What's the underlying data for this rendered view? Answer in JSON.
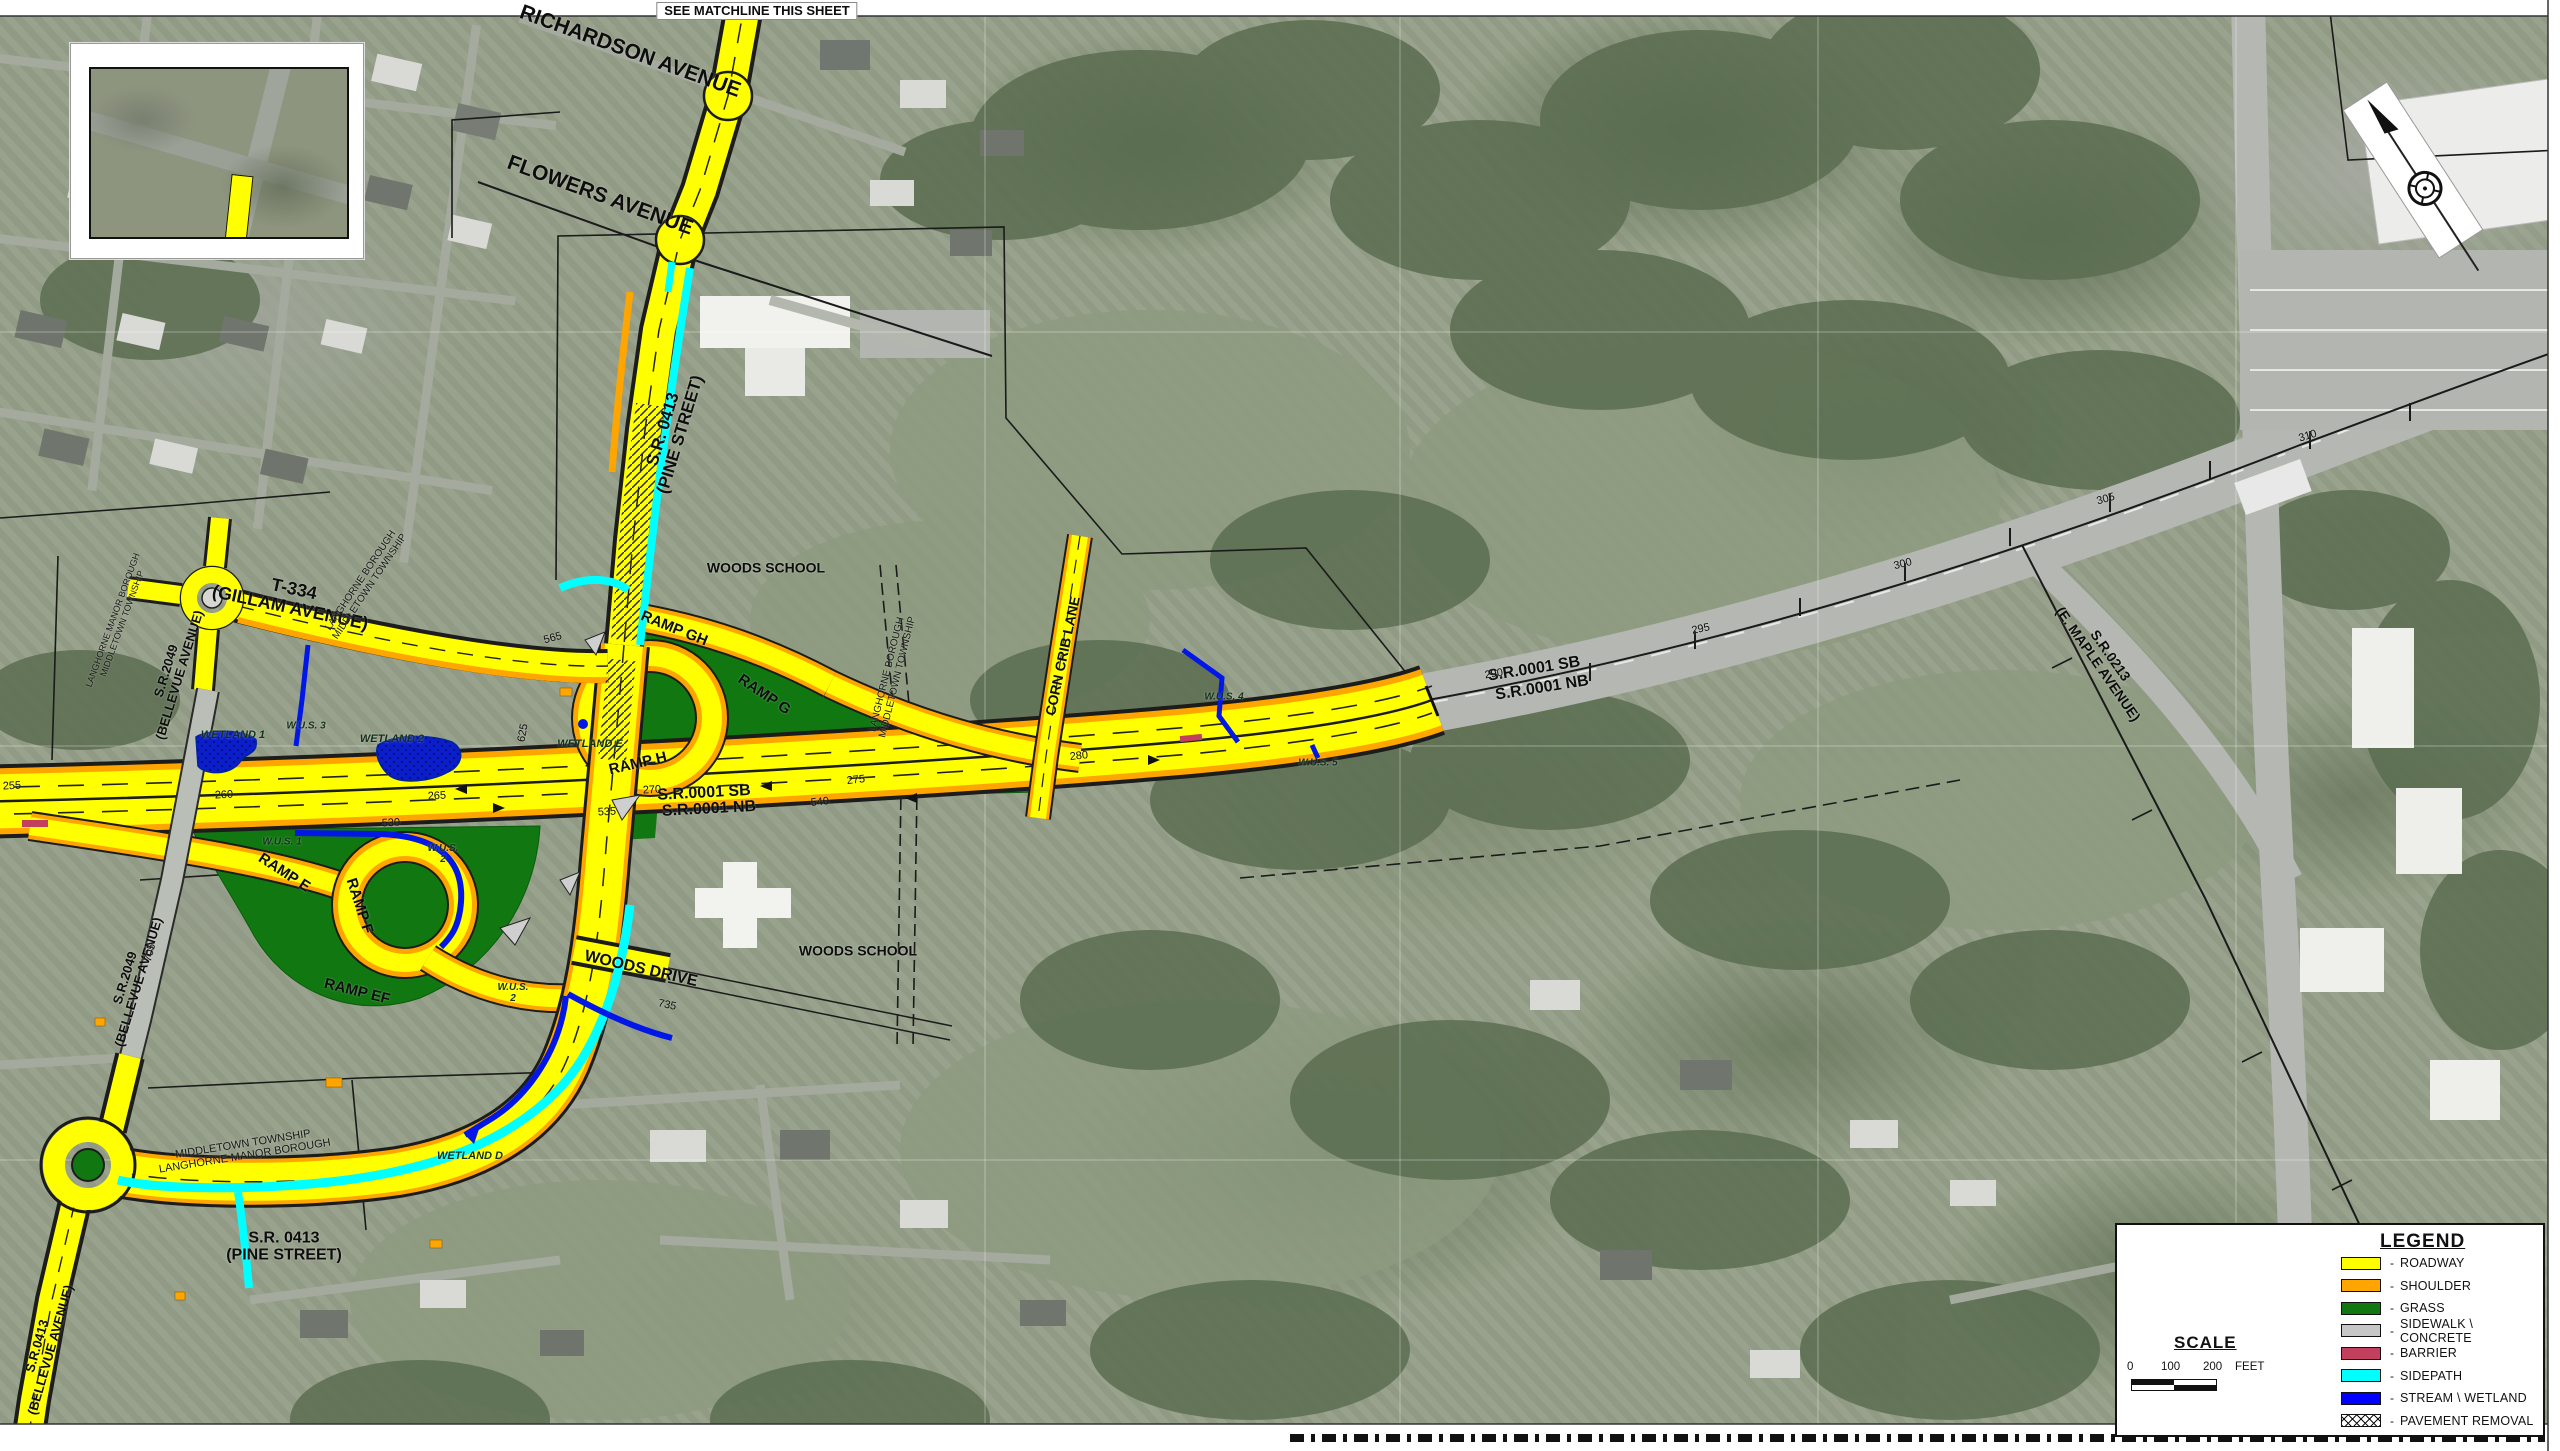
{
  "map": {
    "name": "US 1 / S.R. 0413 interchange roadway design plan on aerial photo",
    "labels": [
      {
        "t": "SEE MATCHLINE THIS SHEET",
        "x": 757,
        "y": 11,
        "r": 0,
        "s": 13,
        "c": "match"
      },
      {
        "t": "RICHARDSON AVENUE",
        "x": 630,
        "y": 52,
        "r": 20,
        "s": 21,
        "c": "road"
      },
      {
        "t": "FLOWERS AVENUE",
        "x": 600,
        "y": 196,
        "r": 20,
        "s": 21,
        "c": "road"
      },
      {
        "t": "S.R. 0413\n(PINE STREET)",
        "x": 672,
        "y": 432,
        "r": -73,
        "s": 17,
        "c": "road"
      },
      {
        "t": "WOODS SCHOOL",
        "x": 766,
        "y": 568,
        "r": 0,
        "s": 14,
        "c": "school"
      },
      {
        "t": "T-334\n(GILLAM AVENUE)",
        "x": 292,
        "y": 599,
        "r": 12,
        "s": 18,
        "c": "road"
      },
      {
        "t": "RAMP GH",
        "x": 674,
        "y": 629,
        "r": 22,
        "s": 15,
        "c": "ramp"
      },
      {
        "t": "RAMP G",
        "x": 764,
        "y": 695,
        "r": 34,
        "s": 15,
        "c": "ramp"
      },
      {
        "t": "RAMP H",
        "x": 638,
        "y": 764,
        "r": -13,
        "s": 15,
        "c": "ramp"
      },
      {
        "t": "RAMP E",
        "x": 284,
        "y": 873,
        "r": 33,
        "s": 15,
        "c": "ramp"
      },
      {
        "t": "RAMP F",
        "x": 359,
        "y": 906,
        "r": 72,
        "s": 15,
        "c": "ramp"
      },
      {
        "t": "RAMP EF",
        "x": 357,
        "y": 992,
        "r": 14,
        "s": 15,
        "c": "ramp"
      },
      {
        "t": "S.R.2049\n(BELLEVUE AVENUE)",
        "x": 173,
        "y": 673,
        "r": -73,
        "s": 13,
        "c": "road"
      },
      {
        "t": "S.R.2049\n(BELLEVUE AVENUE)",
        "x": 132,
        "y": 980,
        "r": -73,
        "s": 13,
        "c": "road"
      },
      {
        "t": "S.R.0413\n(BELLEVUE AVENUE)",
        "x": 44,
        "y": 1348,
        "r": -74,
        "s": 13,
        "c": "road"
      },
      {
        "t": "S.R. 0413\n(PINE STREET)",
        "x": 284,
        "y": 1247,
        "r": 0,
        "s": 16,
        "c": "road"
      },
      {
        "t": "WOODS DRIVE",
        "x": 641,
        "y": 969,
        "r": 13,
        "s": 16,
        "c": "road"
      },
      {
        "t": "WOODS SCHOOL",
        "x": 858,
        "y": 951,
        "r": 0,
        "s": 14,
        "c": "school"
      },
      {
        "t": "CORN CRIB LANE",
        "x": 1063,
        "y": 656,
        "r": -78,
        "s": 14,
        "c": "road"
      },
      {
        "t": "S.R.0001 SB",
        "x": 704,
        "y": 793,
        "r": -3,
        "s": 16,
        "c": "road"
      },
      {
        "t": "S.R.0001 NB",
        "x": 709,
        "y": 809,
        "r": -3,
        "s": 16,
        "c": "road"
      },
      {
        "t": "S.R.0001 SB",
        "x": 1534,
        "y": 669,
        "r": -9,
        "s": 16,
        "c": "road"
      },
      {
        "t": "S.R.0001 NB",
        "x": 1542,
        "y": 688,
        "r": -9,
        "s": 16,
        "c": "road"
      },
      {
        "t": "S.R.0213\n(E. MAPLE AVENUE)",
        "x": 2104,
        "y": 660,
        "r": 55,
        "s": 14,
        "c": "road"
      },
      {
        "t": "WETLAND 1",
        "x": 233,
        "y": 736,
        "r": 0,
        "s": 11,
        "c": "wetland"
      },
      {
        "t": "WETLAND 2",
        "x": 392,
        "y": 740,
        "r": 0,
        "s": 11,
        "c": "wetland"
      },
      {
        "t": "WETLAND E",
        "x": 590,
        "y": 745,
        "r": 0,
        "s": 11,
        "c": "wetland"
      },
      {
        "t": "WETLAND D",
        "x": 470,
        "y": 1157,
        "r": 0,
        "s": 11,
        "c": "wetland"
      },
      {
        "t": "W.U.S. 3",
        "x": 306,
        "y": 727,
        "r": 0,
        "s": 10,
        "c": "wetland"
      },
      {
        "t": "W.U.S. 1",
        "x": 282,
        "y": 843,
        "r": 0,
        "s": 10,
        "c": "wetland"
      },
      {
        "t": "W.U.S.\n2",
        "x": 443,
        "y": 855,
        "r": 0,
        "s": 10,
        "c": "wetland"
      },
      {
        "t": "W.U.S.\n2",
        "x": 513,
        "y": 994,
        "r": 0,
        "s": 10,
        "c": "wetland"
      },
      {
        "t": "W.U.S. 4",
        "x": 1224,
        "y": 698,
        "r": 0,
        "s": 10,
        "c": "wetland"
      },
      {
        "t": "W.U.S. 5",
        "x": 1318,
        "y": 764,
        "r": 0,
        "s": 10,
        "c": "wetland"
      },
      {
        "t": "LANGHORNE BOROUGH\nMIDDLETOWN TOWNSHIP",
        "x": 366,
        "y": 584,
        "r": -56,
        "s": 10,
        "c": "boundary"
      },
      {
        "t": "LANGHORNE BOROUGH\nMIDDLETOWN TOWNSHIP",
        "x": 893,
        "y": 676,
        "r": -76,
        "s": 10,
        "c": "boundary"
      },
      {
        "t": "LANGHORNE MANOR BOROUGH\nMIDDLETOWN TOWNSHIP",
        "x": 118,
        "y": 622,
        "r": -70,
        "s": 9,
        "c": "boundary"
      },
      {
        "t": "MIDDLETOWN TOWNSHIP\nLANGHORNE MANOR BOROUGH",
        "x": 244,
        "y": 1151,
        "r": -9,
        "s": 11,
        "c": "boundary"
      },
      {
        "t": "255",
        "x": 12,
        "y": 787,
        "r": -3,
        "s": 11,
        "c": "station"
      },
      {
        "t": "260",
        "x": 224,
        "y": 796,
        "r": -3,
        "s": 11,
        "c": "station"
      },
      {
        "t": "265",
        "x": 437,
        "y": 797,
        "r": -3,
        "s": 11,
        "c": "station"
      },
      {
        "t": "270",
        "x": 652,
        "y": 791,
        "r": -3,
        "s": 11,
        "c": "station"
      },
      {
        "t": "275",
        "x": 856,
        "y": 781,
        "r": -6,
        "s": 11,
        "c": "station"
      },
      {
        "t": "280",
        "x": 1079,
        "y": 757,
        "r": -6,
        "s": 11,
        "c": "station"
      },
      {
        "t": "290",
        "x": 1494,
        "y": 675,
        "r": -9,
        "s": 11,
        "c": "station"
      },
      {
        "t": "295",
        "x": 1701,
        "y": 630,
        "r": -12,
        "s": 11,
        "c": "station"
      },
      {
        "t": "300",
        "x": 1903,
        "y": 565,
        "r": -14,
        "s": 11,
        "c": "station"
      },
      {
        "t": "305",
        "x": 2106,
        "y": 500,
        "r": -16,
        "s": 11,
        "c": "station"
      },
      {
        "t": "310",
        "x": 2308,
        "y": 437,
        "r": -17,
        "s": 11,
        "c": "station"
      },
      {
        "t": "530",
        "x": 391,
        "y": 824,
        "r": -3,
        "s": 11,
        "c": "station"
      },
      {
        "t": "535",
        "x": 607,
        "y": 813,
        "r": -3,
        "s": 11,
        "c": "station"
      },
      {
        "t": "540",
        "x": 820,
        "y": 803,
        "r": -6,
        "s": 11,
        "c": "station"
      },
      {
        "t": "565",
        "x": 553,
        "y": 639,
        "r": -15,
        "s": 11,
        "c": "station"
      },
      {
        "t": "625",
        "x": 524,
        "y": 733,
        "r": -80,
        "s": 11,
        "c": "station"
      },
      {
        "t": "705",
        "x": 151,
        "y": 953,
        "r": -75,
        "s": 11,
        "c": "station"
      },
      {
        "t": "735",
        "x": 667,
        "y": 1006,
        "r": 12,
        "s": 11,
        "c": "station"
      }
    ]
  },
  "inset": {
    "labels": [
      {
        "t": "S.R.0213\n(MAPLE AVENUE)",
        "x": 190,
        "y": 100,
        "r": 18,
        "s": 12,
        "c": "road"
      },
      {
        "t": "S.R.0413\n(PINE STREET)",
        "x": 289,
        "y": 116,
        "r": -78,
        "s": 12,
        "c": "road"
      },
      {
        "t": "SEE MATCHLINE THIS SHEET",
        "x": 218,
        "y": 247,
        "r": 0,
        "s": 10,
        "c": "inset-match"
      }
    ]
  },
  "legend": {
    "title": "LEGEND",
    "dash": "-",
    "items": [
      {
        "label": "ROADWAY",
        "color": "#FFFF00"
      },
      {
        "label": "SHOULDER",
        "color": "#FFA500"
      },
      {
        "label": "GRASS",
        "color": "#117711"
      },
      {
        "label": "SIDEWALK \\ CONCRETE",
        "color": "#C6C6C6"
      },
      {
        "label": "BARRIER",
        "color": "#C23F5E"
      },
      {
        "label": "SIDEPATH",
        "color": "#00FFFF"
      },
      {
        "label": "STREAM \\ WETLAND",
        "color": "#0000FF"
      },
      {
        "label": "PAVEMENT REMOVAL",
        "color": "hatch"
      }
    ],
    "scale": {
      "title": "SCALE",
      "ticks": [
        "0",
        "100",
        "200"
      ],
      "unit": "FEET"
    }
  },
  "colors": {
    "roadway": "#FFFF00",
    "shoulder": "#FFA500",
    "grass": "#117711",
    "sidewalk": "#C6C6C6",
    "barrier": "#C23F5E",
    "sidepath": "#00FFFF",
    "stream": "#0017E8"
  }
}
